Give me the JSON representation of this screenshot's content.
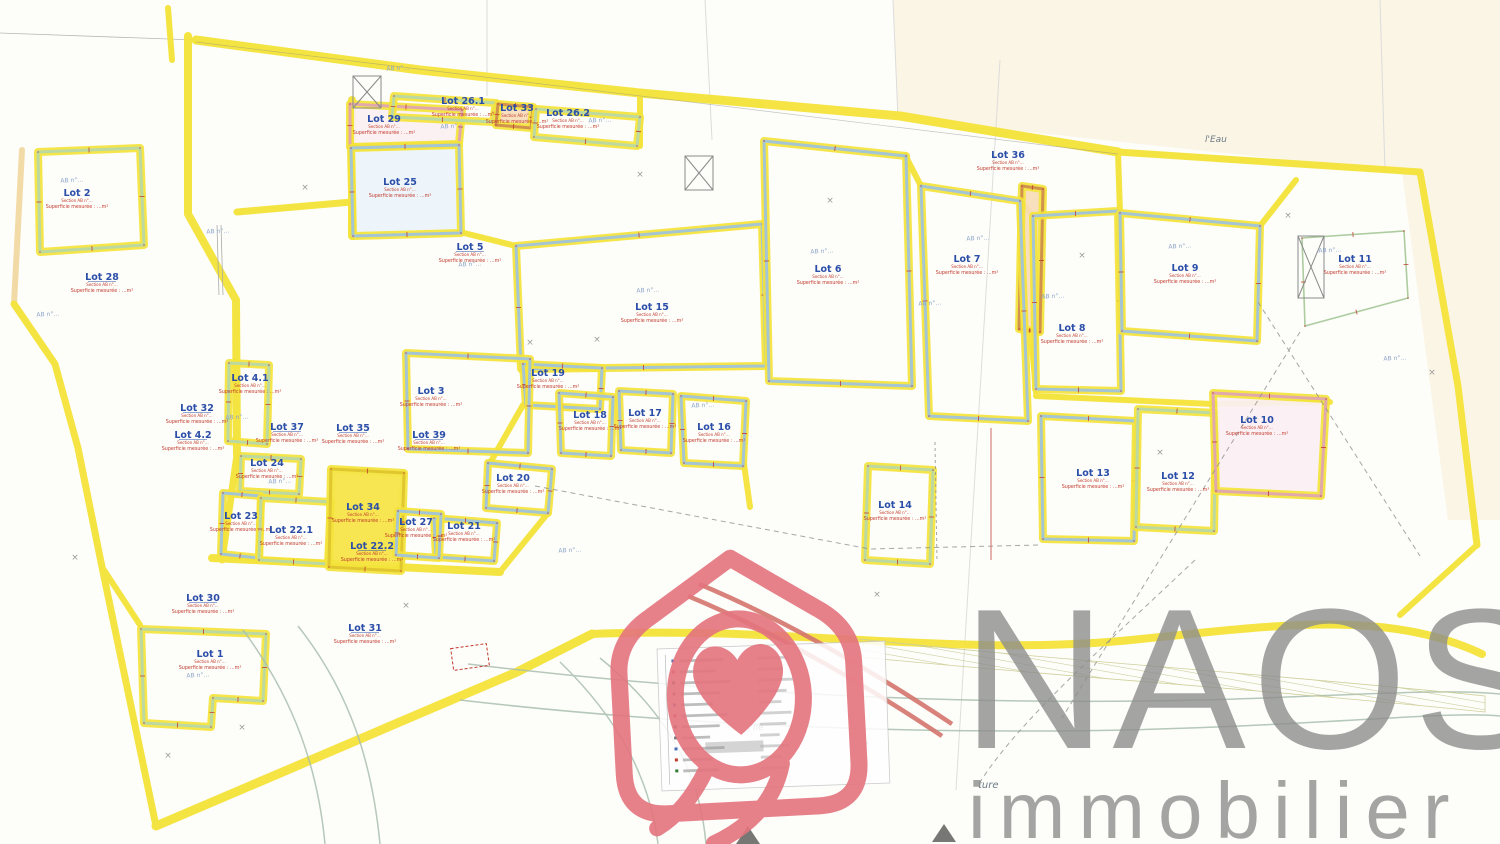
{
  "branding": {
    "name": "NAOS",
    "sub": "immobilier",
    "text_color": "#8e8e8e",
    "logo_color": "#e4747e"
  },
  "plan": {
    "paper": "#fdfdfa",
    "cream": "#faf2df",
    "yellow": "#f4e339",
    "lot_name_color": "#2b4ea8",
    "measure_color": "#c0392b",
    "ref_color": "#8ea6c8",
    "section_note": "Section AB n°…",
    "area_note": "Superficie mesurée : …m²",
    "ab_ref": "AB n°…",
    "lots": [
      {
        "n": "Lot 2",
        "x": 77,
        "y": 196,
        "p": "38,152 140,148 144,245 40,252",
        "c": "#b8d8a8"
      },
      {
        "n": "Lot 28",
        "x": 102,
        "y": 280
      },
      {
        "n": "Lot 29",
        "x": 384,
        "y": 122,
        "p": "350,104 462,110 459,144 350,147",
        "c": "#dfa5b2",
        "f": "#fcf0f2"
      },
      {
        "n": "Lot 26.1",
        "x": 463,
        "y": 104,
        "p": "394,96 496,103 493,122 392,117",
        "c": "#b8d8a8"
      },
      {
        "n": "Lot 33",
        "x": 517,
        "y": 111,
        "p": "498,104 533,107 531,128 496,125",
        "c": "#cf8d4e",
        "f": "#f8ddb8"
      },
      {
        "n": "Lot 26.2",
        "x": 568,
        "y": 116,
        "p": "536,109 640,117 637,146 534,137",
        "c": "#b8d8a8"
      },
      {
        "n": "Lot 25",
        "x": 400,
        "y": 185,
        "p": "351,148 459,145 461,233 353,236",
        "c": "#9fc3dc",
        "f": "#edf5fa"
      },
      {
        "n": "Lot 5",
        "x": 470,
        "y": 250
      },
      {
        "n": "Lot 36",
        "x": 1008,
        "y": 158,
        "p": "1022,186 1043,189 1040,332 1019,329",
        "c": "#cf8d4e",
        "f": "#f8ddb8"
      },
      {
        "n": "Lot 15",
        "x": 652,
        "y": 310,
        "p": "516,246 762,224 766,366 521,369",
        "c": "#9fc3dc"
      },
      {
        "n": "Lot 6",
        "x": 828,
        "y": 272,
        "p": "764,141 906,156 912,386 769,381",
        "c": "#9fc3dc"
      },
      {
        "n": "Lot 7",
        "x": 967,
        "y": 262,
        "p": "921,186 1020,201 1028,421 929,416",
        "c": "#9fc3dc"
      },
      {
        "n": "Lot 8",
        "x": 1072,
        "y": 331,
        "p": "1033,216 1118,211 1121,391 1036,389",
        "c": "#9fc3dc"
      },
      {
        "n": "Lot 9",
        "x": 1185,
        "y": 271,
        "p": "1120,213 1260,226 1257,341 1122,331",
        "c": "#9fc3dc"
      },
      {
        "n": "Lot 11",
        "x": 1355,
        "y": 262,
        "p": "1302,238 1404,231 1408,298 1305,326",
        "c": "#a9c99a",
        "thin": true
      },
      {
        "n": "Lot 19",
        "x": 548,
        "y": 376,
        "p": "523,364 602,368 600,409 526,405",
        "c": "#9fc3dc"
      },
      {
        "n": "Lot 18",
        "x": 590,
        "y": 418,
        "p": "559,393 613,397 611,456 561,453",
        "c": "#9fc3dc"
      },
      {
        "n": "Lot 17",
        "x": 645,
        "y": 416,
        "p": "619,391 673,394 671,453 621,450",
        "c": "#9fc3dc"
      },
      {
        "n": "Lot 16",
        "x": 714,
        "y": 430,
        "p": "681,396 746,401 743,466 684,463",
        "c": "#9fc3dc"
      },
      {
        "n": "Lot 20",
        "x": 513,
        "y": 481,
        "p": "488,463 552,469 548,513 486,508",
        "c": "#9fc3dc"
      },
      {
        "n": "Lot 21",
        "x": 464,
        "y": 529,
        "p": "434,518 497,523 494,561 436,557",
        "c": "#9fc3dc"
      },
      {
        "n": "Lot 3",
        "x": 431,
        "y": 394,
        "p": "406,353 530,359 528,453 408,449",
        "c": "#9fc3dc"
      },
      {
        "n": "Lot 39",
        "x": 429,
        "y": 438
      },
      {
        "n": "Lot 4.1",
        "x": 250,
        "y": 381,
        "p": "229,363 269,365 267,444 228,441",
        "c": "#b8d8a8"
      },
      {
        "n": "Lot 32",
        "x": 197,
        "y": 411
      },
      {
        "n": "Lot 4.2",
        "x": 193,
        "y": 438
      },
      {
        "n": "Lot 37",
        "x": 287,
        "y": 430
      },
      {
        "n": "Lot 35",
        "x": 353,
        "y": 431
      },
      {
        "n": "Lot 24",
        "x": 267,
        "y": 466,
        "p": "241,456 301,459 299,494 240,491",
        "c": "#b8d8a8"
      },
      {
        "n": "Lot 23",
        "x": 241,
        "y": 519,
        "p": "223,493 261,496 259,558 221,554",
        "c": "#9fc3dc"
      },
      {
        "n": "Lot 22.1",
        "x": 291,
        "y": 533,
        "p": "261,498 331,502 328,564 259,560",
        "c": "#b8d8a8"
      },
      {
        "n": "Lot 34",
        "x": 363,
        "y": 510,
        "p": "331,469 404,473 401,571 329,567",
        "c": "#dfc52e",
        "f": "#f7e443"
      },
      {
        "n": "Lot 22.2",
        "x": 372,
        "y": 549
      },
      {
        "n": "Lot 27",
        "x": 416,
        "y": 525,
        "p": "398,511 441,514 439,558 396,555",
        "c": "#9fc3dc"
      },
      {
        "n": "Lot 14",
        "x": 895,
        "y": 508,
        "p": "868,466 933,470 930,564 865,560",
        "c": "#b8d8a8"
      },
      {
        "n": "Lot 13",
        "x": 1093,
        "y": 476,
        "p": "1041,416 1136,421 1134,541 1043,539",
        "c": "#9fc3dc"
      },
      {
        "n": "Lot 12",
        "x": 1178,
        "y": 479,
        "p": "1138,409 1216,413 1214,531 1136,527",
        "c": "#b8d8a8"
      },
      {
        "n": "Lot 10",
        "x": 1257,
        "y": 423,
        "p": "1213,393 1326,399 1321,496 1216,491",
        "c": "#dfa5b2",
        "f": "#fbf1f4"
      },
      {
        "n": "Lot 30",
        "x": 203,
        "y": 601
      },
      {
        "n": "Lot 1",
        "x": 210,
        "y": 657,
        "p": "141,629 266,634 263,701 213,698 211,727 144,723",
        "c": "#b8d8a8"
      },
      {
        "n": "Lot 31",
        "x": 365,
        "y": 631
      }
    ],
    "ab_refs": [
      [
        72,
        182
      ],
      [
        48,
        316
      ],
      [
        218,
        233
      ],
      [
        398,
        70
      ],
      [
        452,
        128
      ],
      [
        600,
        122
      ],
      [
        648,
        292
      ],
      [
        822,
        253
      ],
      [
        930,
        305
      ],
      [
        978,
        240
      ],
      [
        1053,
        298
      ],
      [
        1180,
        248
      ],
      [
        1330,
        252
      ],
      [
        703,
        407
      ],
      [
        570,
        552
      ],
      [
        280,
        483
      ],
      [
        237,
        419
      ],
      [
        198,
        677
      ],
      [
        470,
        266
      ],
      [
        1395,
        360
      ]
    ],
    "crosses": [
      [
        640,
        177
      ],
      [
        830,
        203
      ],
      [
        1288,
        218
      ],
      [
        1432,
        375
      ],
      [
        597,
        342
      ],
      [
        877,
        597
      ],
      [
        242,
        730
      ],
      [
        406,
        608
      ],
      [
        1082,
        258
      ],
      [
        530,
        345
      ],
      [
        168,
        758
      ],
      [
        75,
        560
      ],
      [
        1160,
        455
      ],
      [
        305,
        190
      ]
    ],
    "texts": [
      {
        "t": "l'Ile",
        "x": 748,
        "y": 731,
        "s": 9,
        "r": -4
      },
      {
        "t": "de",
        "x": 858,
        "y": 746,
        "s": 8,
        "r": 0
      },
      {
        "t": "ture",
        "x": 978,
        "y": 788,
        "s": 10,
        "r": 0
      },
      {
        "t": "l'Eau",
        "x": 1205,
        "y": 142,
        "s": 9,
        "r": 0
      }
    ],
    "legend": {
      "x": 657,
      "y": 649,
      "w": 228,
      "h": 142,
      "rows": [
        44,
        36,
        50,
        40,
        32,
        46,
        38,
        28,
        42,
        30,
        36
      ],
      "bullet_colors": [
        "#4a6fb5",
        "#c0392b",
        "#2e7d32",
        "#777"
      ]
    }
  }
}
